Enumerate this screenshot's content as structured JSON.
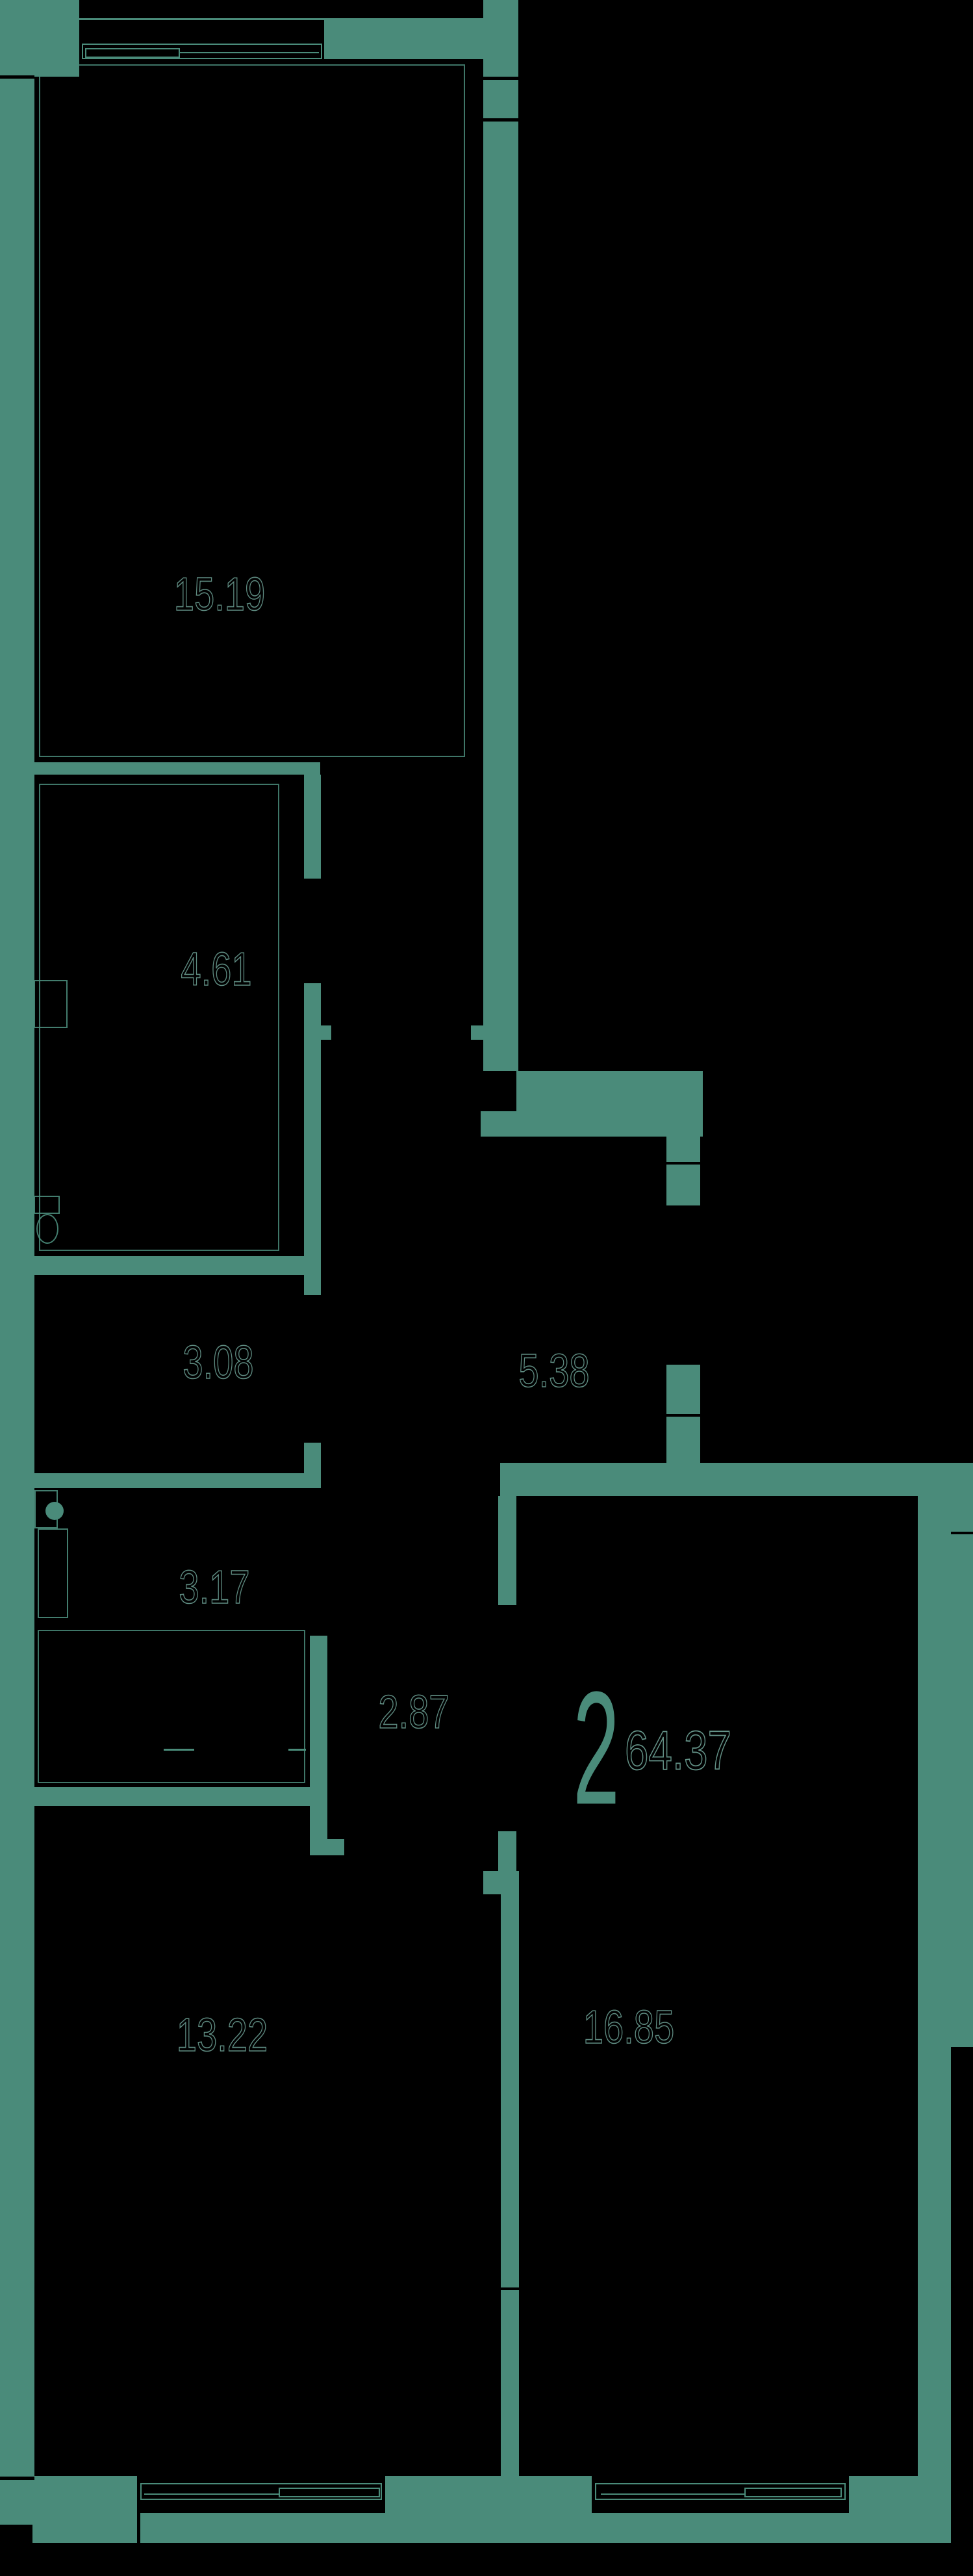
{
  "plan": {
    "type": "apartment-floor-plan",
    "unit": {
      "rooms_count": "2",
      "total_area": "64.37"
    },
    "room_areas": [
      {
        "id": "room-top",
        "area": "15.19"
      },
      {
        "id": "bathroom",
        "area": "4.61"
      },
      {
        "id": "hallway",
        "area": "5.38"
      },
      {
        "id": "storage",
        "area": "3.08"
      },
      {
        "id": "wc",
        "area": "3.17"
      },
      {
        "id": "corridor",
        "area": "2.87"
      },
      {
        "id": "bedroom-left",
        "area": "13.22"
      },
      {
        "id": "living-right",
        "area": "16.85"
      }
    ],
    "colors": {
      "wall": "#4a8b7a",
      "background": "#000000",
      "label_stroke": "#6fa296"
    }
  }
}
